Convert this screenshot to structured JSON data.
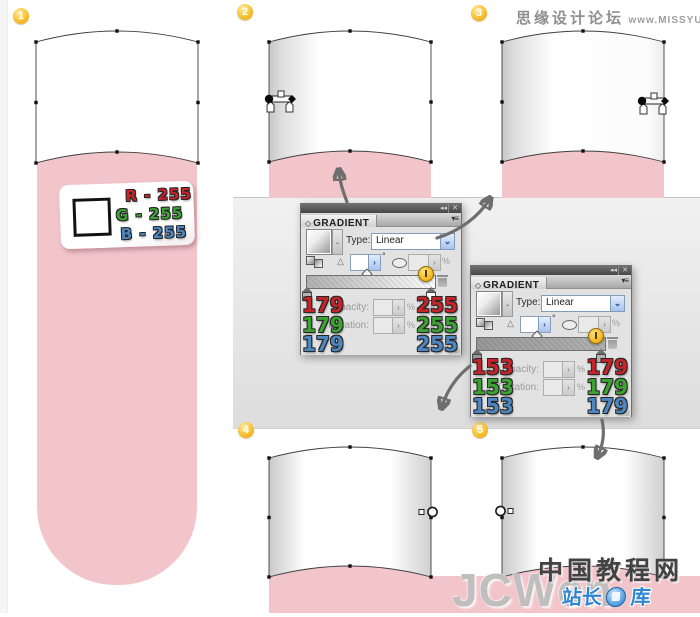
{
  "colors": {
    "pink": "#f2c5cb",
    "value_red": "#c5242b",
    "value_green": "#3da234",
    "value_blue": "#4d86c0",
    "badge_gold": "#f2b01e",
    "arrow_gray": "#6e6e6e",
    "panel_body_gray": "#e2e2e2"
  },
  "icons": {
    "collapse": "◂◂",
    "close": "✕",
    "panel_menu": "▾≡",
    "panel_diamond": "◇",
    "angle_triangle": "△",
    "spinner_arrow": "›",
    "select_chevron": "⌄",
    "resize_grip": "◢"
  },
  "header": {
    "site_name": "思缘设计论坛",
    "site_url": "www.MISSYUAN.COM"
  },
  "badges": {
    "step1": "1",
    "step2": "2",
    "step3": "3",
    "step4": "4",
    "step5": "5"
  },
  "rgb_label": {
    "r_line": "R - 255",
    "g_line": "G - 255",
    "b_line": "B - 255"
  },
  "panels": [
    {
      "title": "GRADIENT",
      "type_label": "Type:",
      "type_value": "Linear",
      "degree": "°",
      "percent": "%",
      "opacity_label": "Opacity:",
      "location_label": "Location:",
      "left": {
        "r": "179",
        "g": "179",
        "b": "179",
        "hex": "#b3b3b3"
      },
      "right": {
        "r": "255",
        "g": "255",
        "b": "255",
        "hex": "#ffffff"
      }
    },
    {
      "title": "GRADIENT",
      "type_label": "Type:",
      "type_value": "Linear",
      "degree": "°",
      "percent": "%",
      "opacity_label": "Opacity:",
      "location_label": "Location:",
      "left": {
        "r": "153",
        "g": "153",
        "b": "153",
        "hex": "#999999"
      },
      "right": {
        "r": "179",
        "g": "179",
        "b": "179",
        "hex": "#b3b3b3"
      }
    }
  ],
  "watermark": {
    "cn_site": "中国教程网",
    "latin": "JCWcn",
    "blue_left": "站长",
    "blue_right": "库"
  }
}
